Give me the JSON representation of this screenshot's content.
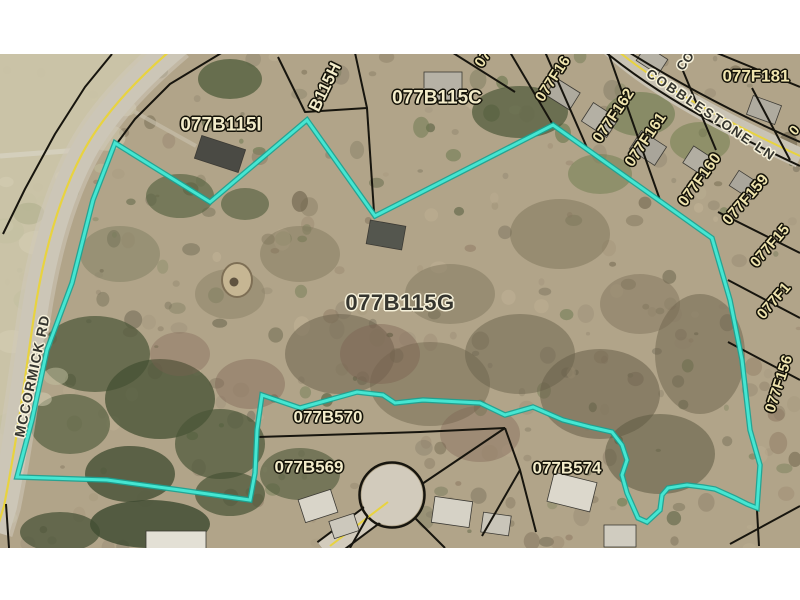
{
  "map": {
    "selected_parcel": {
      "id": "077B115G"
    },
    "parcel_labels": {
      "b115i": "077B115I",
      "b115h": "B115H",
      "b115c": "077B115C",
      "b115g": "077B115G",
      "b570": "077B570",
      "b569": "077B569",
      "b574": "077B574",
      "f162": "077F162",
      "f161": "077F161",
      "f160": "077F160",
      "f159": "077F159",
      "f156": "077F156",
      "f181": "077F181",
      "f164_partial": "07",
      "f163_partial": "077F16",
      "f158_partial": "077F15",
      "f157_partial": "077F1",
      "f180_partial": "0"
    },
    "road_labels": {
      "mccormick": "MCCORMICK RD",
      "cobblestone": "COBBLESTONE LN",
      "cobblestone_partial": "CO"
    },
    "colors": {
      "highlight": "#3BDCC9",
      "parcel_line": "#17150E",
      "label_cream": "#EFE4AE",
      "label_dark": "#35352F",
      "road_centerline": "#E8D33F"
    }
  }
}
